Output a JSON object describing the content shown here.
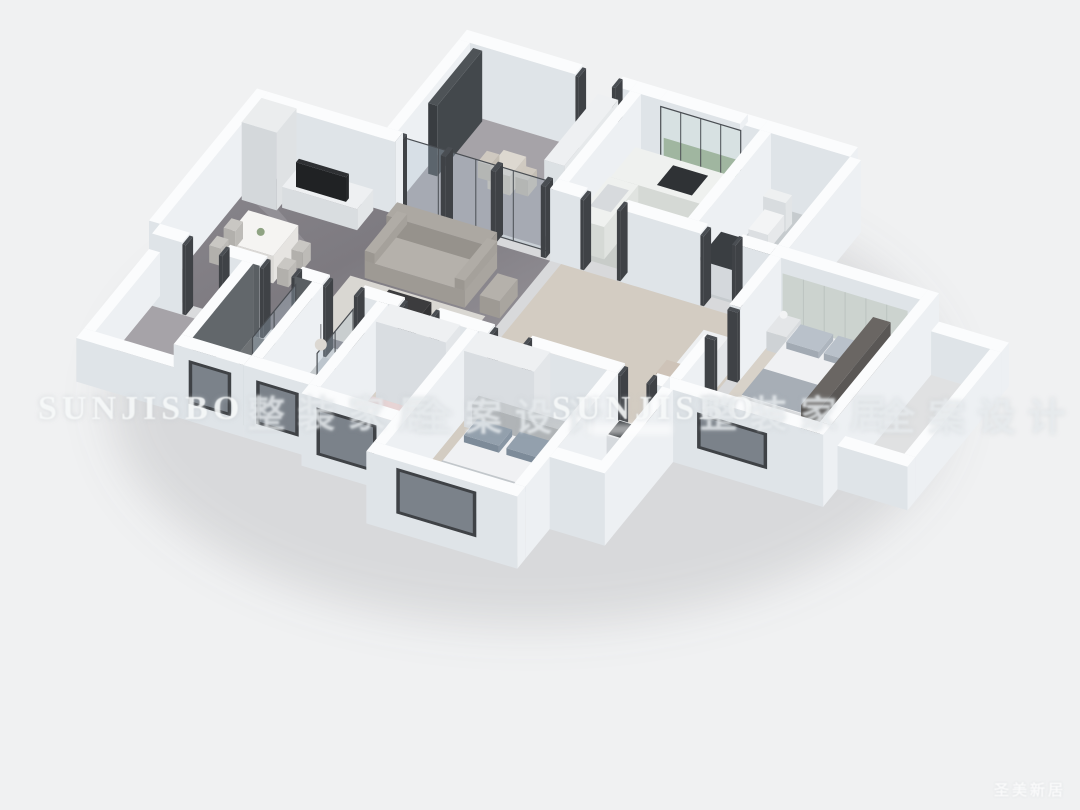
{
  "page": {
    "background": "#f0f1f2",
    "canvas_width": 1080,
    "canvas_height": 810
  },
  "watermarks": {
    "brand": "SUNJISBO",
    "corner": "圣美新居",
    "band": [
      {
        "kind": "brand",
        "text": "SUNJISBO",
        "x": 38,
        "y": 390
      },
      {
        "kind": "cn",
        "text": "整装家居",
        "x": 248,
        "y": 384
      },
      {
        "kind": "cn",
        "text": "全案设计",
        "x": 415,
        "y": 387
      },
      {
        "kind": "brand",
        "text": "SUNJISBO",
        "x": 552,
        "y": 390
      },
      {
        "kind": "cn",
        "text": "整装家居",
        "x": 700,
        "y": 384
      },
      {
        "kind": "cn",
        "text": "全案设计",
        "x": 878,
        "y": 387
      }
    ]
  },
  "scene": {
    "type": "3d-floorplan-render",
    "view": "isometric-dollhouse",
    "rooms": [
      {
        "name": "entry-balcony",
        "features": [
          "glass-sliding-partition",
          "dark-curtain",
          "small-table-with-chairs",
          "built-in-cabinet"
        ]
      },
      {
        "name": "living-dining-room",
        "floor": "dark-marble",
        "features": [
          "tv-cabinet-wall",
          "display-cabinet",
          "gray-sofa",
          "armchair",
          "coffee-table",
          "rug",
          "dining-table-with-four-chairs"
        ]
      },
      {
        "name": "kitchen",
        "floor": "light-tile",
        "features": [
          "l-shaped-counter",
          "cooktop",
          "window-with-greenery"
        ]
      },
      {
        "name": "bathroom-north",
        "floor": "light-tile",
        "features": [
          "vanity-counter-dark-top",
          "toilet"
        ]
      },
      {
        "name": "hallway",
        "floor": "wood",
        "features": [
          "dresser",
          "stool"
        ]
      },
      {
        "name": "bedroom-east",
        "floor": "wood",
        "features": [
          "double-bed",
          "paneled-headboard-wall",
          "nightstand",
          "dark-wardrobe",
          "window"
        ]
      },
      {
        "name": "east-balcony",
        "floor": "tile",
        "features": [
          "parapet-walls"
        ]
      },
      {
        "name": "west-balcony",
        "floor": "marble",
        "features": [
          "parapet-walls"
        ]
      },
      {
        "name": "shower-bathroom",
        "floor": "dark-tile",
        "features": [
          "dark-tile-walls",
          "glass-shower-screen",
          "vanity",
          "window"
        ]
      },
      {
        "name": "bathroom-middle",
        "floor": "tile",
        "features": [
          "pendant-light",
          "glass-shower",
          "toilet",
          "window"
        ]
      },
      {
        "name": "bedroom-small",
        "floor": "wood",
        "features": [
          "pink-bed",
          "white-wardrobe",
          "desk",
          "large-window"
        ]
      },
      {
        "name": "master-bedroom",
        "floor": "wood",
        "features": [
          "double-bed",
          "gray-pillows",
          "white-wardrobe",
          "window"
        ]
      },
      {
        "name": "ensuite-bathroom",
        "floor": "tile",
        "features": [
          "toilet",
          "washbasin"
        ]
      }
    ]
  },
  "palette": {
    "background": "#f0f1f2",
    "wall_top": "#fbfcfd",
    "wall_east": "#edf0f3",
    "wall_south": "#dfe4e8",
    "frame_dark": "#4a4e53",
    "frame_darker": "#3f4246",
    "marble_a": "#7e7b81",
    "marble_b": "#9a979d",
    "marble_light": "#a6a3a8",
    "wood": "#d3ccc2",
    "wood_light": "#d8d2c9",
    "tile_light": "#c6cbce",
    "tile_kitchen": "#c8ccc9",
    "tile_dark": "#6f7376",
    "dark_tile_wall": "#5a5f63",
    "dark_tile_wall2": "#62676b",
    "glass": "rgba(168,188,202,0.32)",
    "sofa": "#b5b1ab",
    "sofa_dark": "#aca8a2",
    "rug": "#d9d7d2",
    "table_dark": "#3c3c3e",
    "white_furniture": "#eef0f2",
    "wardrobe_dark": "#5a5755",
    "bed_white": "#f0f1f3",
    "bed_gray": "#c2c7cb",
    "pillow_blue": "#93a0ad",
    "bed_pink": "#e7d4d5",
    "pillow_pink": "#eedde0",
    "greenery": "#9db48d",
    "tv_dark": "#2e3033",
    "cooktop": "#2f3235",
    "shadow": "rgba(120,126,132,0.20)"
  }
}
